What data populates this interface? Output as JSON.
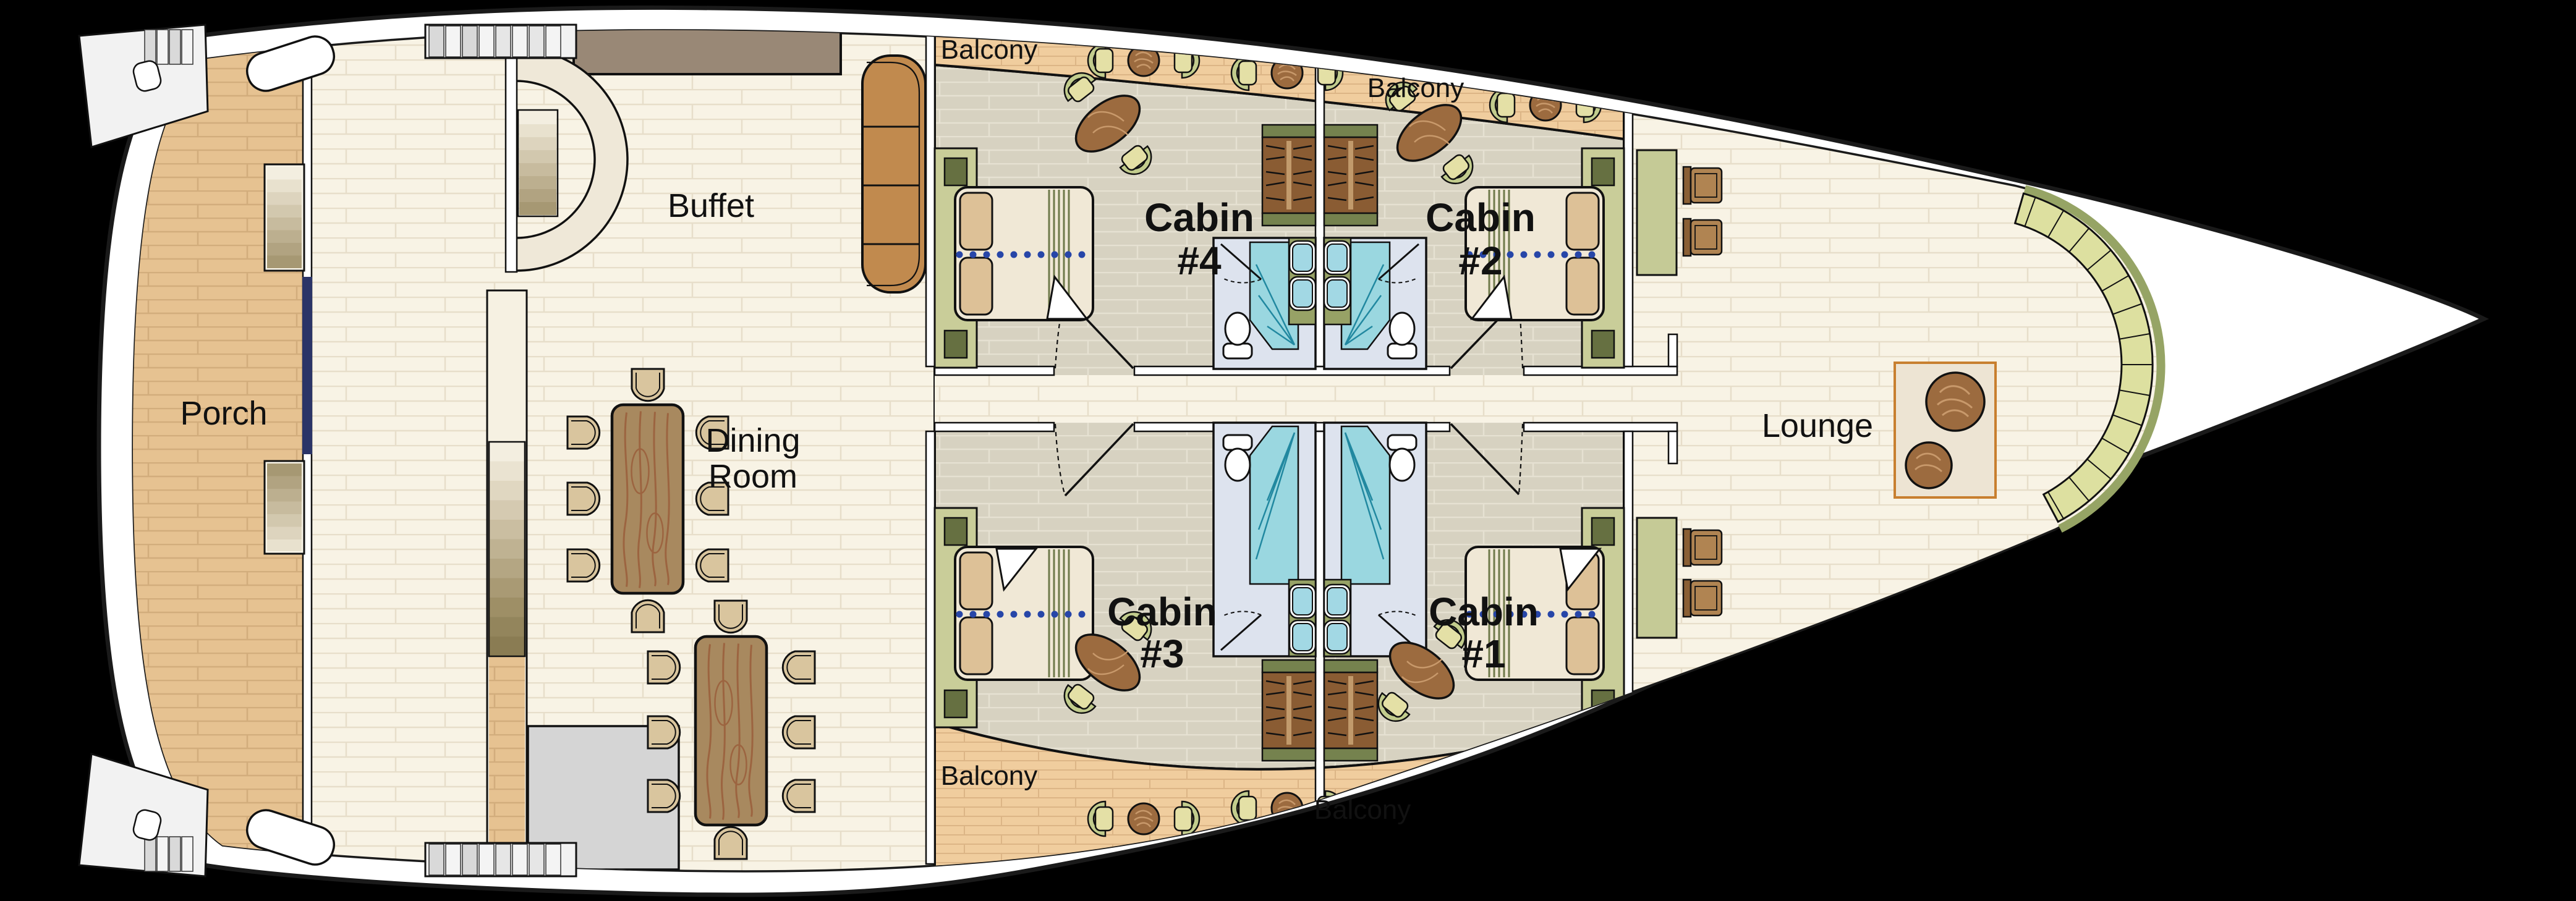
{
  "plan": {
    "type": "deck floor plan",
    "rooms": {
      "porch": "Porch",
      "buffet": "Buffet",
      "dining_line1": "Dining",
      "dining_line2": "Room",
      "lounge": "Lounge"
    },
    "cabins": {
      "word": "Cabin",
      "cabin4_num": "#4",
      "cabin2_num": "#2",
      "cabin3_num": "#3",
      "cabin1_num": "#1"
    },
    "balconies": {
      "top_left": "Balcony",
      "top_right": "Balcony",
      "bottom_left": "Balcony",
      "bottom_right": "Balcony"
    },
    "colors": {
      "background": "#000000",
      "hull": "#FFFFFF",
      "outline": "#1A1A1A",
      "floor": "#F8F3E5",
      "floor_line": "#E7DECA",
      "porch": "#E6C291",
      "balcony": "#F0CD9E",
      "cabin_floor": "#D7D2C1",
      "table_wood": "#A8895F",
      "wood_grain": "#9C6440",
      "round_table": "#9C6B3F",
      "counter": "#C18A4E",
      "buffet_counter": "#998876",
      "bench": "#DDE0A0",
      "bench_edge": "#96A465",
      "bath_floor": "#DDE3EE",
      "shower": "#9AD7E0",
      "shower_fold": "#2188A0",
      "sink": "#A2D8E4",
      "olive": "#97A266",
      "wardrobe": "#8A5C33",
      "headboard": "#C9CD99",
      "bed": "#F0E8D6",
      "pillow": "#DDC197",
      "dot_line": "#2746A8",
      "navy_wall": "#2B3467",
      "rug": "#EDE4D3",
      "rug_border": "#C87F2F",
      "chair_tan": "#D9C59E",
      "chair_green": "#E4E0A6",
      "gray_block": "#D5D5D5"
    }
  }
}
